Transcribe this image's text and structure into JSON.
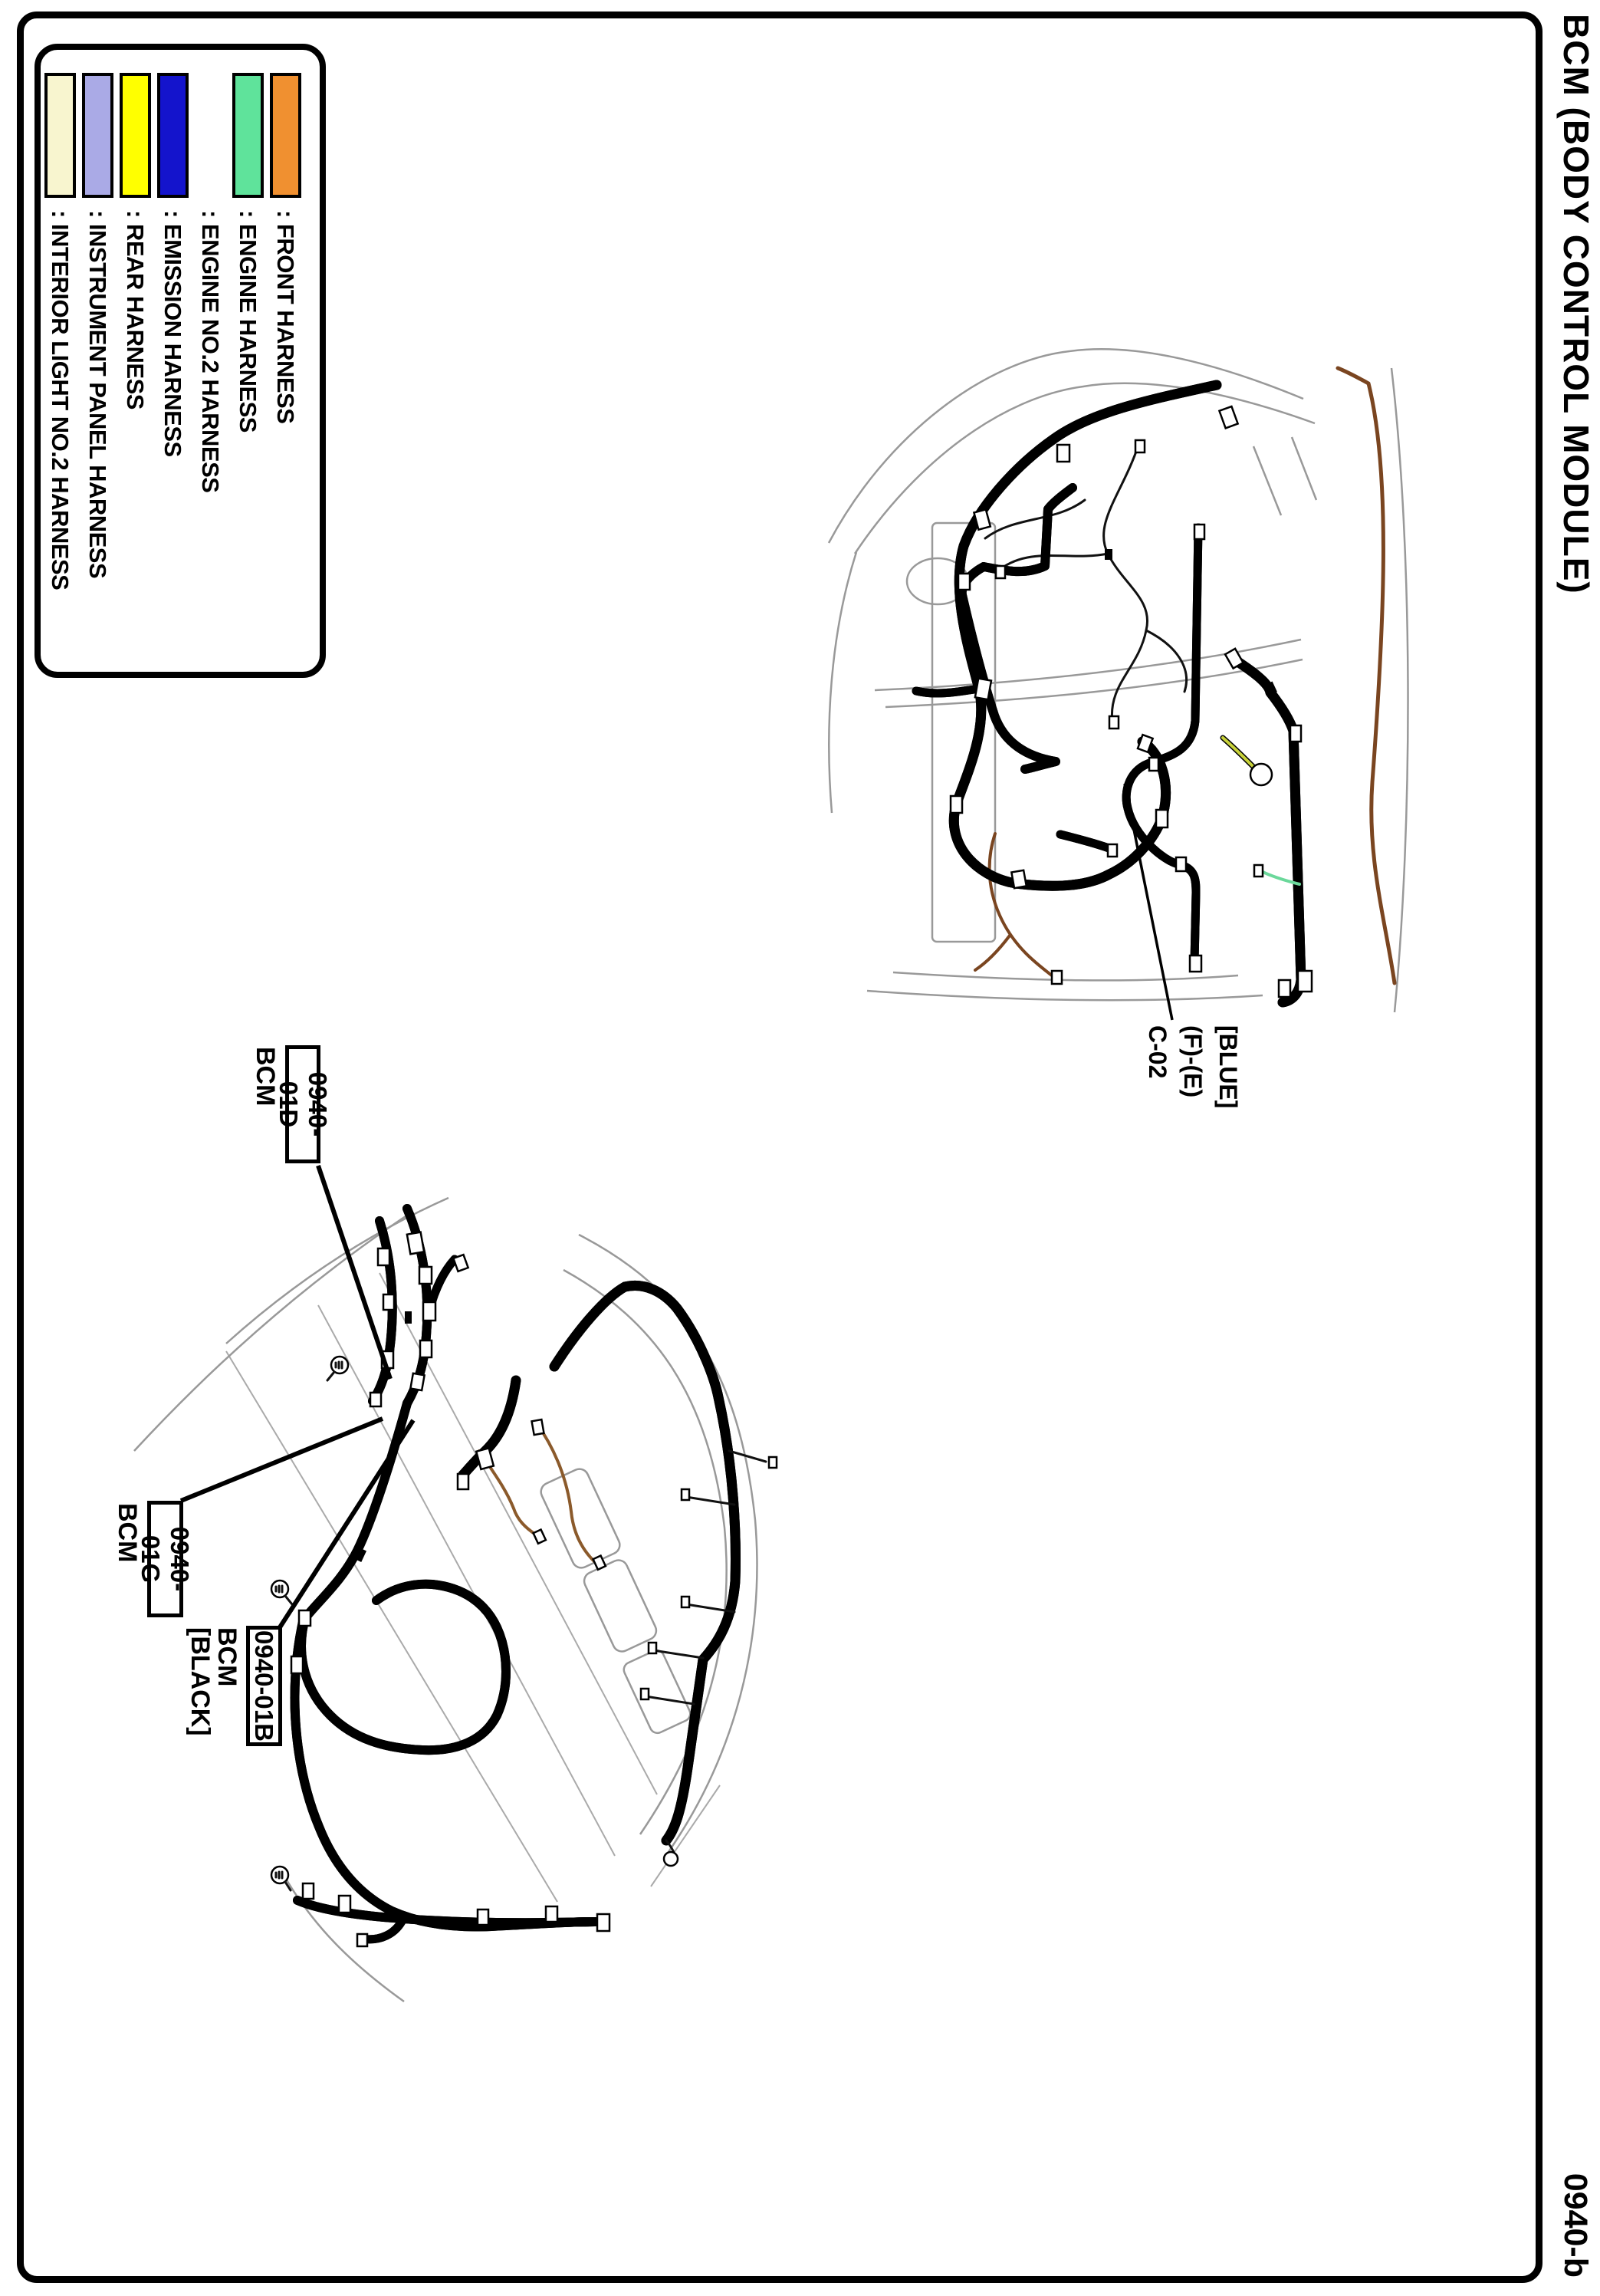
{
  "title": "BCM (BODY CONTROL MODULE)",
  "page_code": "0940-b",
  "legend": {
    "items": [
      {
        "label": ": FRONT HARNESS",
        "color": "#F09030"
      },
      {
        "label": ": ENGINE HARNESS",
        "color": "#5FE39B"
      },
      {
        "label": ": ENGINE NO.2 HARNESS",
        "color": ""
      },
      {
        "label": ": EMISSION HARNESS",
        "color": "#1414CC"
      },
      {
        "label": ": REAR HARNESS",
        "color": "#FFFF00"
      },
      {
        "label": ": INSTRUMENT PANEL HARNESS",
        "color": "#AAAAE6"
      },
      {
        "label": ": INTERIOR LIGHT NO.2 HARNESS",
        "color": "#F8F5CF"
      }
    ]
  },
  "callouts": {
    "d": {
      "code": "0940-01D",
      "name": "BCM"
    },
    "g": {
      "code": "0940-01G",
      "name": "BCM"
    },
    "b": {
      "code": "0940-01B",
      "name": "BCM",
      "variant": "[BLACK]"
    },
    "connector": {
      "line1": "[BLUE]",
      "line2": "(F)-(E)",
      "line3": "C-02"
    }
  },
  "colors": {
    "front": "#F09030",
    "engine": "#5FE39B",
    "emission": "#1414CC",
    "rear": "#FFFF00",
    "instrument_panel": "#AAAAE6",
    "interior_light_no2": "#F8F5CF",
    "engine_bay_brown": "#7A4520"
  }
}
